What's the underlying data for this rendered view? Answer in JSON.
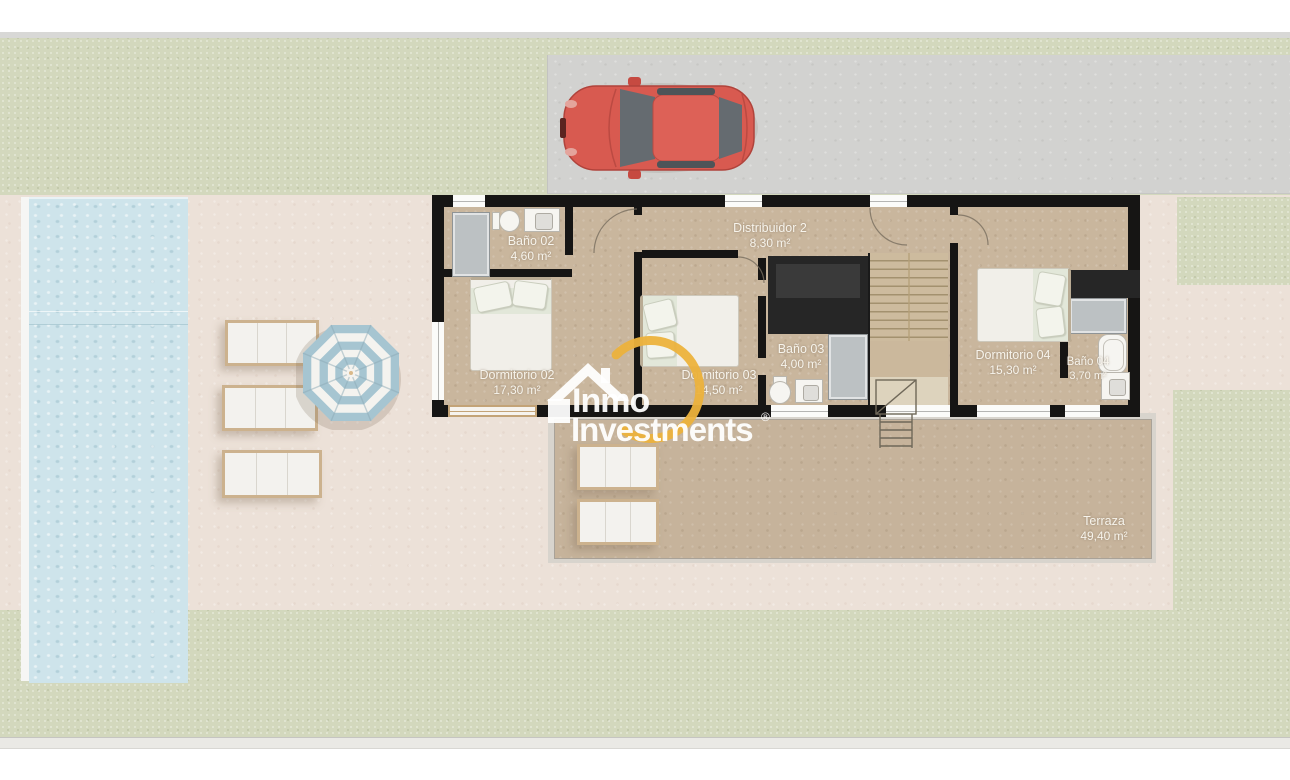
{
  "plan": {
    "rooms": [
      {
        "name": "Baño 02",
        "area": "4,60 m²"
      },
      {
        "name": "Distribuidor 2",
        "area": "8,30 m²"
      },
      {
        "name": "Dormitorio 02",
        "area": "17,30 m²"
      },
      {
        "name": "Dormitorio 03",
        "area": "14,50 m²"
      },
      {
        "name": "Baño 03",
        "area": "4,00 m²"
      },
      {
        "name": "Dormitorio 04",
        "area": "15,30 m²"
      },
      {
        "name": "Baño 04",
        "area": "3,70 m²"
      },
      {
        "name": "Terraza",
        "area": "49,40 m²"
      }
    ]
  },
  "watermark": {
    "brand_line1": "Inmo",
    "brand_line2": "Investments",
    "registered_mark": "®"
  },
  "colors": {
    "grass": "#d3d8bd",
    "patio": "#ece1d8",
    "driveway": "#d2d2d0",
    "pool_water": "#cee4eb",
    "wall": "#161514",
    "floor_tan": "#c9b69d",
    "terrace_floor": "#c6b39b",
    "logo_yellow": "#ecb23c",
    "car_red": "#d85a50",
    "umbrella_blue": "#a6c5d1",
    "label_text": "#f7f4ec"
  }
}
